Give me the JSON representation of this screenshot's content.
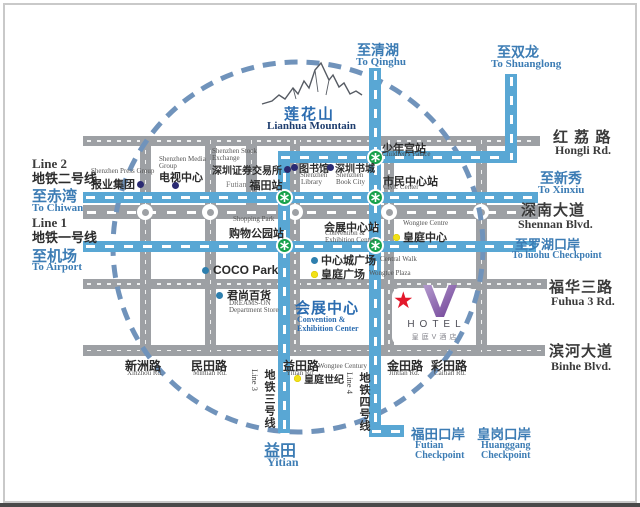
{
  "colors": {
    "metro_blue": "#59a7d4",
    "road_gray": "#9da0a4",
    "circle_blue": "#7093bb",
    "station_green": "#17a14b",
    "navy_dot": "#2a2a72",
    "blue_dot": "#2e7fae",
    "yellow_dot": "#f2e117",
    "landmark_blue": "#2b6cb0",
    "destination_blue": "#3c7cb4",
    "hotel_purple": "#7d4f9e",
    "star_red": "#e3182b"
  },
  "legend_left": {
    "line2_en": "Line 2",
    "line2_cn": "地铁二号线",
    "to_chiwan_cn": "至赤湾",
    "to_chiwan_en": "To Chiwan",
    "line1_en": "Line 1",
    "line1_cn": "地铁一号线",
    "to_airport_cn": "至机场",
    "to_airport_en": "To Airport"
  },
  "destinations": {
    "qinghu_cn": "至清湖",
    "qinghu_en": "To Qinghu",
    "shuanglong_cn": "至双龙",
    "shuanglong_en": "To Shuanglong",
    "xinxiu_cn": "至新秀",
    "xinxiu_en": "To Xinxiu",
    "luohu_cn": "至罗湖口岸",
    "luohu_en": "To luohu Checkpoint",
    "yitian_cn": "益田",
    "yitian_en": "Yitian",
    "futian_checkpoint_cn": "福田口岸",
    "futian_checkpoint_en_line1": "Futian",
    "futian_checkpoint_en_line2": "Checkpoint",
    "huanggang_checkpoint_cn": "皇岗口岸",
    "huanggang_checkpoint_en_line1": "Huanggang",
    "huanggang_checkpoint_en_line2": "Checkpoint"
  },
  "roads": {
    "hongli_cn": "红 荔 路",
    "hongli_en": "Hongli Rd.",
    "shennan_cn": "深南大道",
    "shennan_en": "Shennan Blvd.",
    "fuhua_cn": "福华三路",
    "fuhua_en": "Fuhua 3 Rd.",
    "binhe_cn": "滨河大道",
    "binhe_en": "Binhe Blvd.",
    "xinzhou_cn": "新洲路",
    "xinzhou_en": "Xinzhou Rd.",
    "mintian_cn": "民田路",
    "mintian_en": "Mintian Rd.",
    "yitian_cn": "益田路",
    "yitian_en": "Yitian Rd.",
    "jintian_cn": "金田路",
    "jintian_en": "Jintian Rd.",
    "caitian_cn": "彩田路",
    "caitian_en": "Caitian Rd."
  },
  "metro": {
    "line3_cn": "地铁三号线",
    "line3_en": "Line 3",
    "line4_cn": "地铁四号线",
    "line4_en": "Line 4"
  },
  "mountain": {
    "cn": "莲花山",
    "en": "Lianhua Mountain"
  },
  "stations": {
    "futian_en": "Futian",
    "futian_cn": "福田站",
    "children_palace_cn": "少年宫站",
    "children_palace_en": "Children's Palace",
    "civic_center_cn": "市民中心站",
    "civic_center_en": "Civic Center",
    "shopping_park_en": "Shopping Park",
    "shopping_park_cn": "购物公园站",
    "convention_cn": "会展中心站",
    "convention_en_line1": "Convention &",
    "convention_en_line2": "Exhibition Center"
  },
  "pois": {
    "press_group_en": "Shenzhen Press Group",
    "press_group_cn": "报业集团",
    "media_group_en_line1": "Shenzhen Media",
    "media_group_en_line2": "Group",
    "media_group_cn": "电视中心",
    "stock_exchange_en_line1": "Shenzhen Stock",
    "stock_exchange_en_line2": "Exchange",
    "stock_exchange_cn": "深圳证券交易所",
    "library_cn": "图书馆",
    "library_en_line1": "Shenzhen",
    "library_en_line2": "Library",
    "book_city_cn": "深圳书城",
    "book_city_en_line1": "Shenzhen",
    "book_city_en_line2": "Book City",
    "wongtee_centre_en": "Wongtee Centre",
    "wongtee_centre_cn": "皇庭中心",
    "central_walk_cn": "中心城广场",
    "central_walk_en": "Central Walk",
    "wongtee_plaza_cn": "皇庭广场",
    "wongtee_plaza_en": "Wongtee Plaza",
    "coco_park": "COCO Park",
    "dreams_on_cn": "君尚百货",
    "dreams_on_en_line1": "DREAMS-ON",
    "dreams_on_en_line2": "Department Store",
    "convention_centre_cn": "会展中心",
    "convention_centre_en_line1": "Convention &",
    "convention_centre_en_line2": "Exhibition Center",
    "wongtee_century_en": "Wongtee Century",
    "wongtee_century_cn": "皇庭世纪"
  },
  "hotel": {
    "star": "★",
    "name": "HOTEL",
    "cn": "皇庭V酒店"
  }
}
